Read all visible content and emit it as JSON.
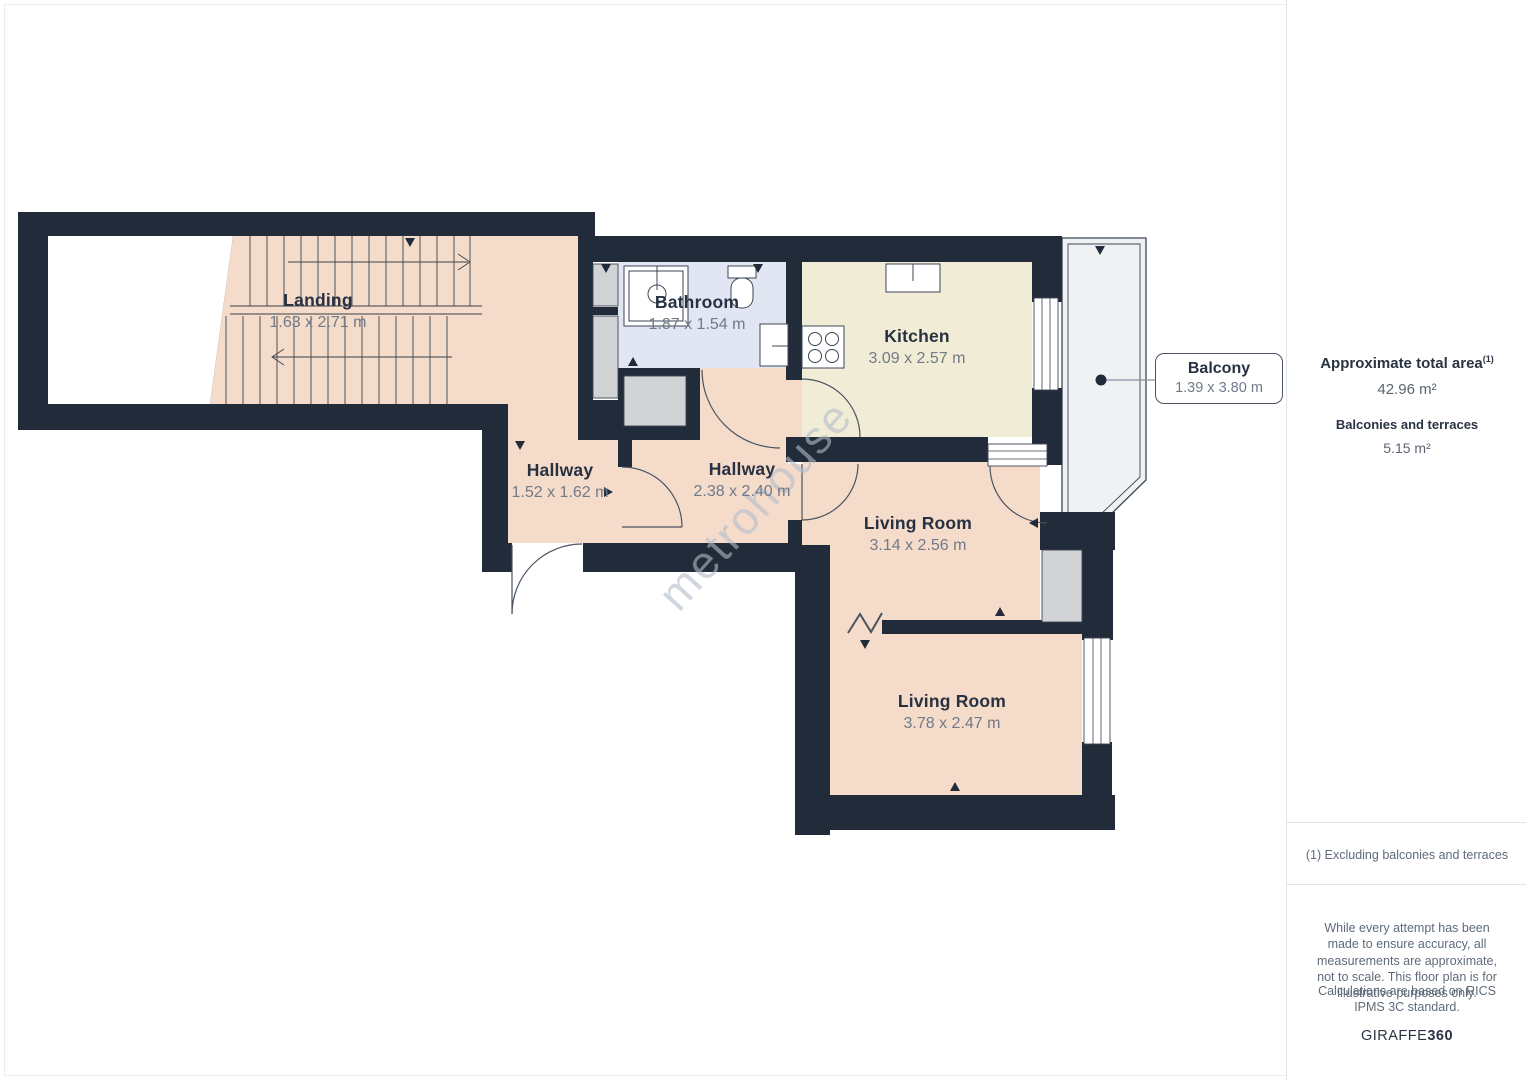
{
  "floorplan": {
    "watermark": "metrohouse",
    "rooms": [
      {
        "name": "Landing",
        "dims": "1.63 x 2.71 m"
      },
      {
        "name": "Bathroom",
        "dims": "1.87 x 1.54 m"
      },
      {
        "name": "Kitchen",
        "dims": "3.09 x 2.57 m"
      },
      {
        "name": "Hallway",
        "dims": "1.52 x 1.62 m"
      },
      {
        "name": "Hallway",
        "dims": "2.38 x 2.40 m"
      },
      {
        "name": "Living Room",
        "dims": "3.14 x 2.56 m"
      },
      {
        "name": "Living Room",
        "dims": "3.78 x 2.47 m"
      }
    ],
    "callout": {
      "name": "Balcony",
      "dims": "1.39 x 3.80 m"
    },
    "colors": {
      "wall": "#212b39",
      "room_fill": "#f5dbca",
      "kitchen_fill": "#f1ecd6",
      "bathroom_fill": "#e1e6f2",
      "balcony_fill": "#eff1f3",
      "furniture_gray": "#d2d3d5"
    }
  },
  "sidebar": {
    "total_area_label": "Approximate total area",
    "total_area_superscript": "(1)",
    "total_area_value": "42.96 m²",
    "balconies_label": "Balconies and terraces",
    "balconies_value": "5.15 m²",
    "footnote": "(1) Excluding balconies and terraces",
    "disclaimer1": "While every attempt has been made to ensure accuracy, all measurements are approximate, not to scale. This floor plan is for illustrative purposes only.",
    "disclaimer2": "Calculations are based on RICS IPMS 3C standard.",
    "brand_name": "GIRAFFE",
    "brand_number": "360"
  }
}
